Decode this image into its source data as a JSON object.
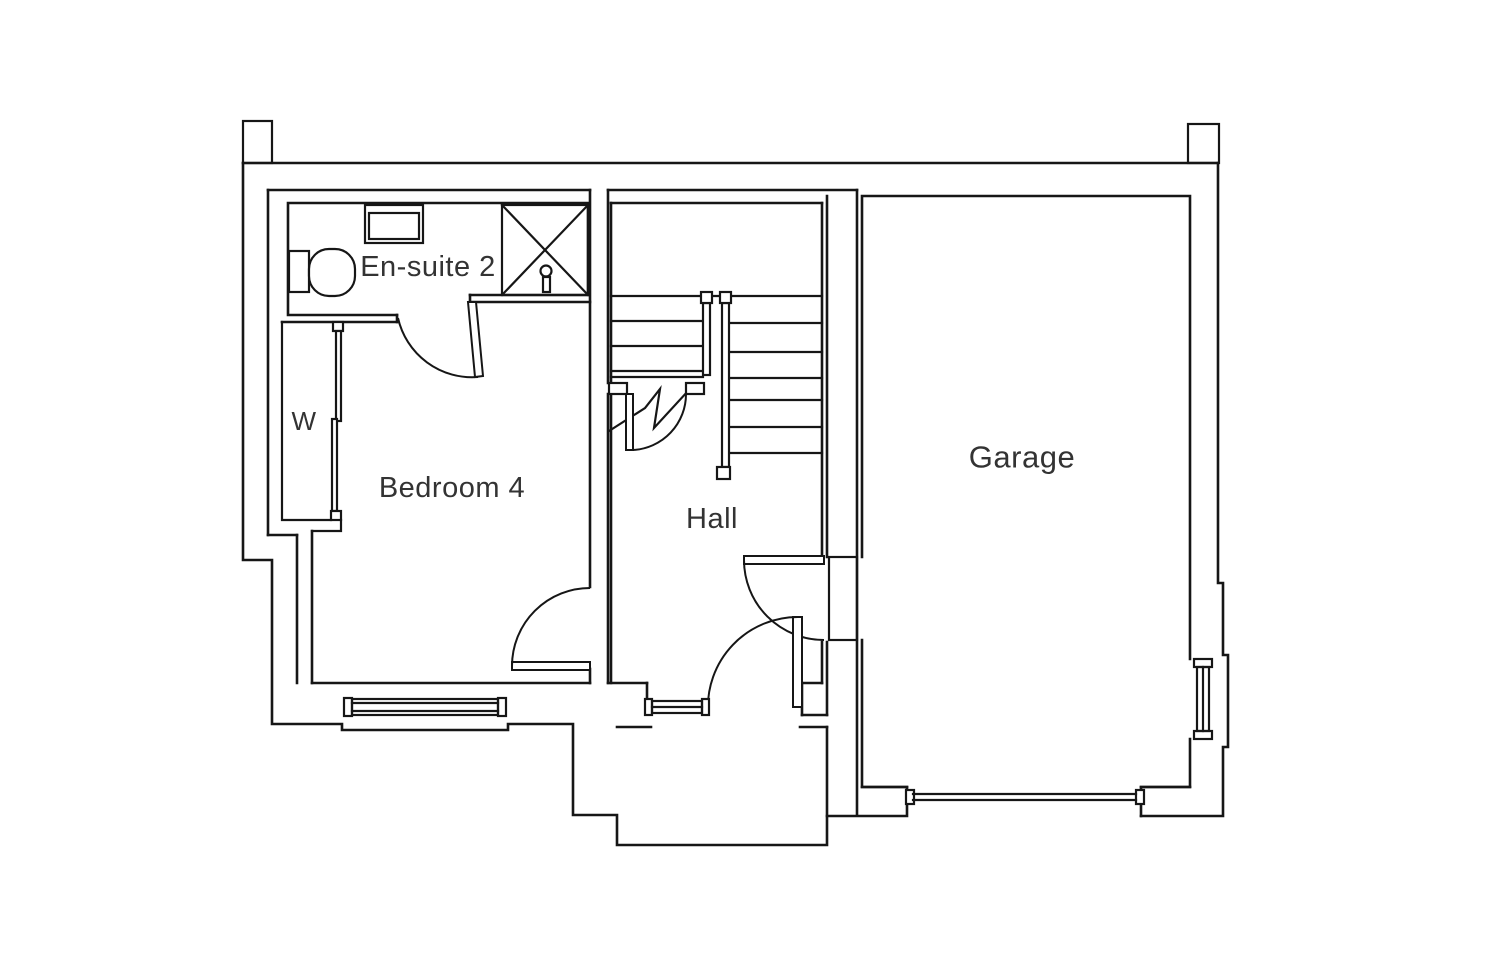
{
  "plan": {
    "type": "floor-plan",
    "rooms": [
      {
        "id": "en-suite-2",
        "label": "En-suite 2",
        "label_x": 428,
        "label_y": 267
      },
      {
        "id": "bedroom-4",
        "label": "Bedroom 4",
        "label_x": 452,
        "label_y": 488
      },
      {
        "id": "hall",
        "label": "Hall",
        "label_x": 712,
        "label_y": 519
      },
      {
        "id": "garage",
        "label": "Garage",
        "label_x": 1022,
        "label_y": 457
      },
      {
        "id": "wardrobe",
        "label": "W",
        "label_x": 304,
        "label_y": 421
      }
    ],
    "fixtures": [
      {
        "name": "toilet-icon",
        "room": "en-suite-2"
      },
      {
        "name": "basin-icon",
        "room": "en-suite-2"
      },
      {
        "name": "shower-enclosure-icon",
        "room": "en-suite-2"
      },
      {
        "name": "sliding-wardrobe-icon",
        "room": "bedroom-4"
      },
      {
        "name": "staircase-icon",
        "room": "hall"
      },
      {
        "name": "stair-break-line-icon",
        "room": "hall"
      },
      {
        "name": "window-icon",
        "room": "bedroom-4"
      },
      {
        "name": "window-icon",
        "room": "hall"
      },
      {
        "name": "window-icon",
        "room": "garage"
      },
      {
        "name": "garage-door-icon",
        "room": "garage"
      },
      {
        "name": "door-swing-icon",
        "room": "en-suite-2"
      },
      {
        "name": "door-swing-icon",
        "room": "bedroom-4"
      },
      {
        "name": "door-swing-icon",
        "room": "hall"
      },
      {
        "name": "front-door-swing-icon",
        "room": "hall"
      },
      {
        "name": "porch-outline",
        "room": "hall"
      }
    ],
    "colors": {
      "line": "#161616",
      "text": "#333333",
      "background": "#ffffff"
    }
  }
}
